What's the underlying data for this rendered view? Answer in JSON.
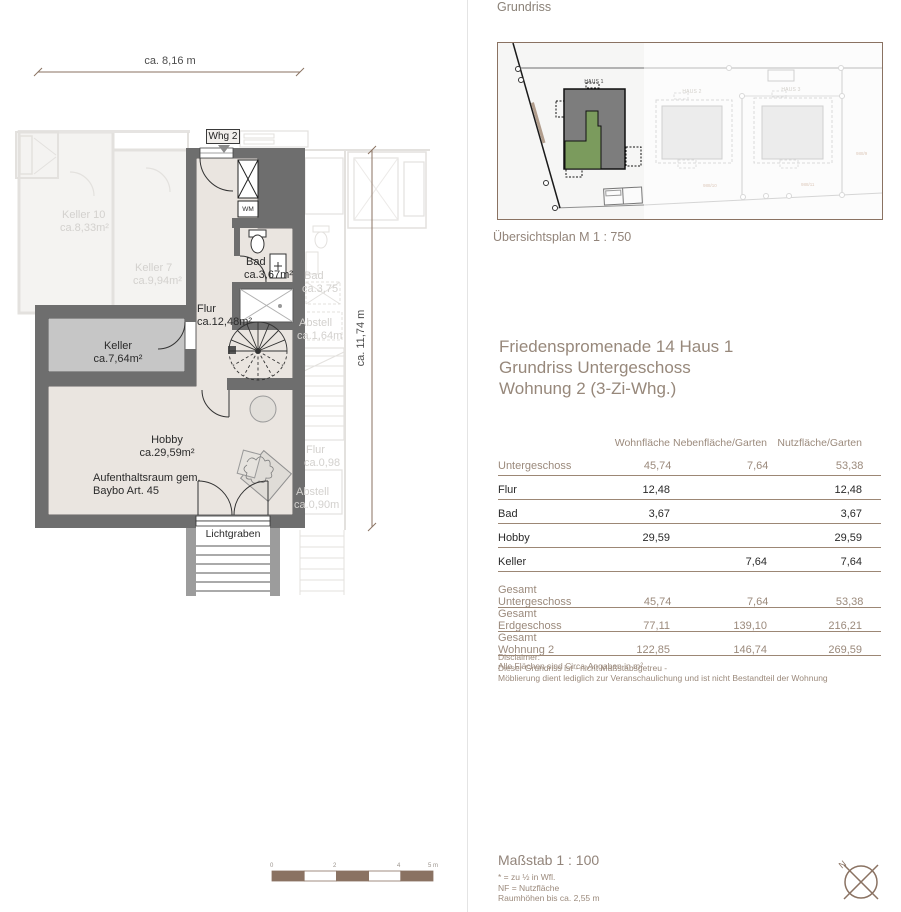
{
  "colors": {
    "accent_brown": "#8a7262",
    "muted_text": "#9b8a7c",
    "wall_gray": "#6e6e6e",
    "floor_beige": "#eae5e0",
    "keller_gray": "#c6c6c6",
    "highlight_green": "#7b9b5d",
    "haus_gray": "#7d7d7d"
  },
  "floor_plan": {
    "dim_top": "ca. 8,16 m",
    "dim_right": "ca. 11,74 m",
    "unit_tag": "Whg 2",
    "wm": "WM",
    "rooms": {
      "bad": {
        "name": "Bad",
        "area": "ca.3,67m²"
      },
      "flur": {
        "name": "Flur",
        "area": "ca.12,48m²"
      },
      "keller": {
        "name": "Keller",
        "area": "ca.7,64m²"
      },
      "hobby": {
        "name": "Hobby",
        "area": "ca.29,59m²"
      }
    },
    "hobby_note": [
      "Aufenthaltsraum gem.",
      "Baybo Art. 45"
    ],
    "lichtgraben": "Lichtgraben",
    "faded_rooms": {
      "keller10": {
        "name": "Keller 10",
        "area": "ca.8,33m²"
      },
      "keller7": {
        "name": "Keller 7",
        "area": "ca.9,94m²"
      },
      "bad": {
        "name": "Bad",
        "area": "ca.3,75"
      },
      "abstell_top": {
        "name": "Abstell",
        "area": "ca.1,64m"
      },
      "flur": {
        "name": "Flur",
        "area": "ca.0,98"
      },
      "abstell_bottom": {
        "name": "Abstell",
        "area": "ca.0,90m"
      }
    },
    "scale_bar_ticks": [
      "0",
      "2",
      "4",
      "5 m"
    ]
  },
  "panel": {
    "header": "Grundriss",
    "overview": {
      "caption": "Übersichtsplan M 1 : 750",
      "haus1": "HAUS 1",
      "haus2": "HAUS 2",
      "haus3": "HAUS 3",
      "parcel_left": "988/10",
      "parcel_mid": "988/11",
      "parcel_right": "988/9"
    },
    "title": [
      "Friedenspromenade 14 Haus 1",
      "Grundriss Untergeschoss",
      "Wohnung 2 (3-Zi-Whg.)"
    ],
    "table": {
      "headers": [
        "Wohnfläche",
        "Nebenfläche/Garten",
        "Nutzfläche/Garten"
      ],
      "rows": [
        {
          "label": "Untergeschoss",
          "muted": true,
          "values": [
            "45,74",
            "7,64",
            "53,38"
          ]
        },
        {
          "label": "Flur",
          "muted": false,
          "values": [
            "12,48",
            "",
            "12,48"
          ]
        },
        {
          "label": "Bad",
          "muted": false,
          "values": [
            "3,67",
            "",
            "3,67"
          ]
        },
        {
          "label": "Hobby",
          "muted": false,
          "values": [
            "29,59",
            "",
            "29,59"
          ]
        },
        {
          "label": "Keller",
          "muted": false,
          "values": [
            "",
            "7,64",
            "7,64"
          ]
        }
      ],
      "totals": [
        {
          "label": "Gesamt Untergeschoss",
          "values": [
            "45,74",
            "7,64",
            "53,38"
          ]
        },
        {
          "label": "Gesamt Erdgeschoss",
          "values": [
            "77,11",
            "139,10",
            "216,21"
          ]
        },
        {
          "label": "Gesamt Wohnung 2",
          "values": [
            "122,85",
            "146,74",
            "269,59"
          ]
        }
      ],
      "footnote": "Alle Flächen sind Circa-Angaben in m²"
    },
    "disclaimer": [
      "Disclaimer:",
      "Dieser Grundriss ist - nicht Maßstabsgetreu -",
      "Möblierung dient lediglich zur Veranschaulichung und ist nicht Bestandteil der Wohnung"
    ],
    "scale_block": {
      "title": "Maßstab 1 : 100",
      "notes": [
        "* = zu ½ in Wfl.",
        "NF = Nutzfläche",
        "Raumhöhen bis ca. 2,55 m"
      ]
    },
    "north": "N"
  }
}
